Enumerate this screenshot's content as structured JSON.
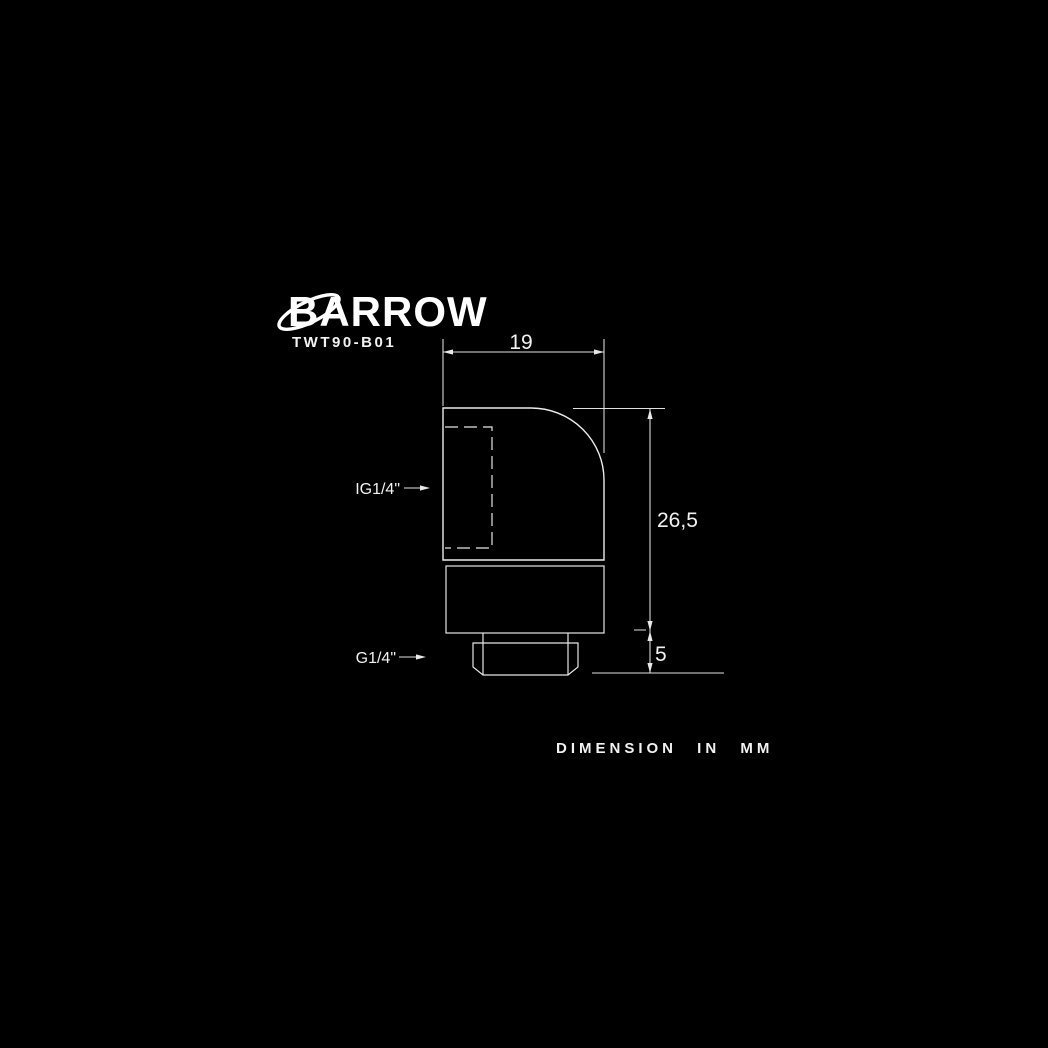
{
  "brand": {
    "name": "BARROW",
    "model": "TWT90-B01"
  },
  "drawing": {
    "type": "technical-drawing",
    "subject": "90-degree rotary fitting side view",
    "dimensions": {
      "width_mm": "19",
      "body_height_mm": "26,5",
      "thread_length_mm": "5"
    },
    "labels": {
      "inner_thread": "IG1/4\"",
      "outer_thread": "G1/4\""
    }
  },
  "footer": {
    "note": "DIMENSION IN MM"
  },
  "colors": {
    "background": "#000000",
    "line": "#ececec",
    "text": "#f2f2f2"
  }
}
